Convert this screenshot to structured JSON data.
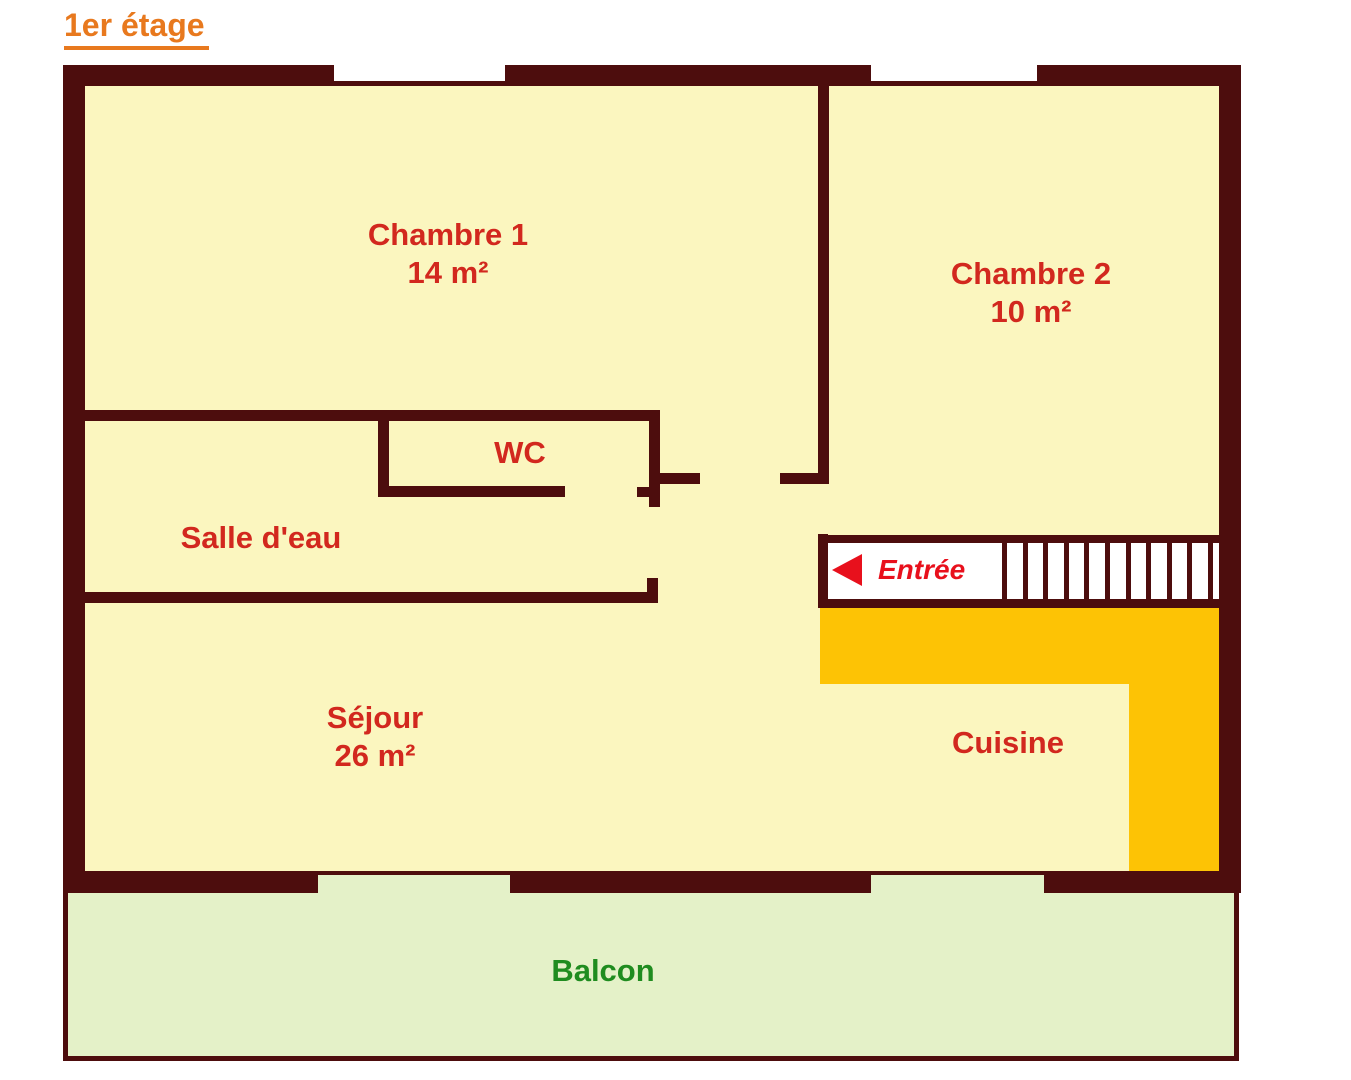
{
  "title": "1er étage",
  "rooms": {
    "chambre1": {
      "name": "Chambre 1",
      "area": "14 m²"
    },
    "chambre2": {
      "name": "Chambre 2",
      "area": "10 m²"
    },
    "wc": {
      "name": "WC"
    },
    "salle_eau": {
      "name": "Salle d'eau"
    },
    "sejour": {
      "name": "Séjour",
      "area": "26 m²"
    },
    "cuisine": {
      "name": "Cuisine"
    },
    "entree": {
      "name": "Entrée"
    },
    "balcon": {
      "name": "Balcon"
    }
  },
  "stairs": {
    "steps": 11
  },
  "colors": {
    "wall": "#4D0D0D",
    "floor": "#FBF6BF",
    "kitchen-zone": "#FDC305",
    "balcony": "#E4F1C8",
    "stairwell": "#FFFFFF",
    "label-red": "#D2281E",
    "entree-red": "#E8101C",
    "title-orange": "#E8791E",
    "balcon-green": "#1F8C1F"
  }
}
